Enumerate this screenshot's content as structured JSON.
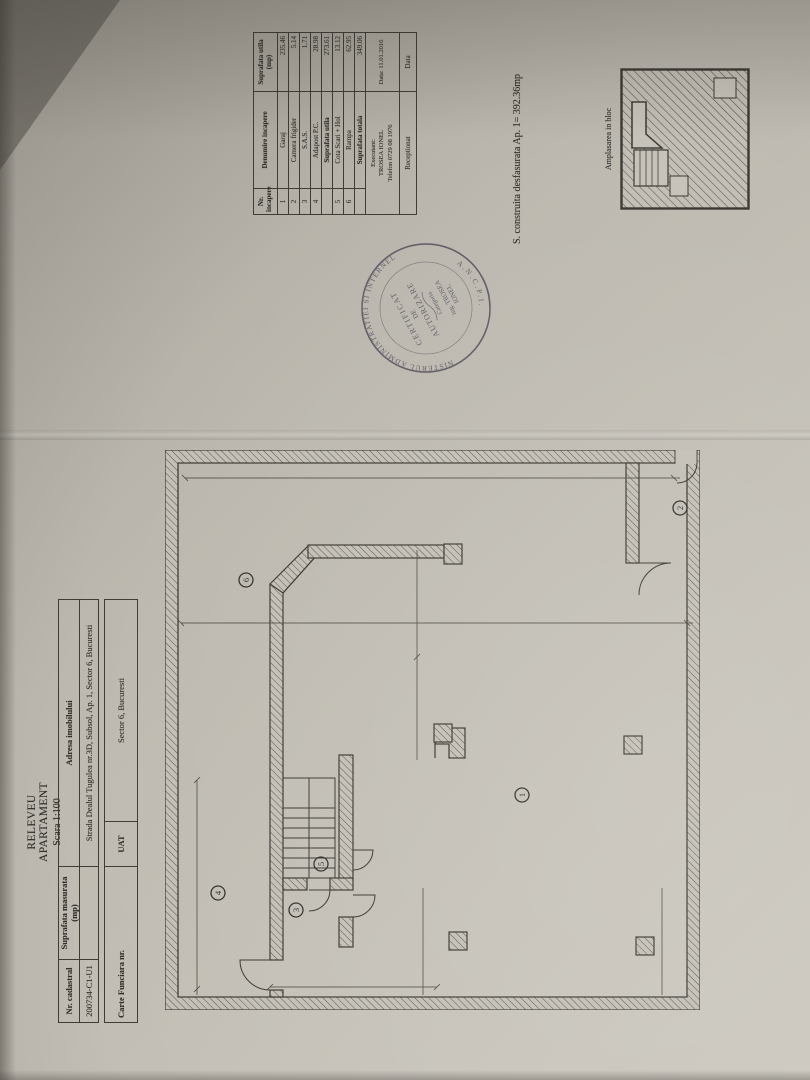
{
  "document": {
    "title": "RELEVEU APARTAMENT",
    "scale": "Scara 1:100",
    "cadastral_table": {
      "headers": [
        "Nr. cadastral",
        "Suprafata masurata (mp)",
        "Adresa imobilului"
      ],
      "values": [
        "200734-C1-U1",
        "",
        "Strada Dealul Tugulea nr.3D, Subsol, Ap. 1, Sector 6, Bucuresti"
      ]
    },
    "cf_table": {
      "label": "Carte Funciara nr.",
      "cf_value": "",
      "uat_label": "UAT",
      "uat_value": "Sector 6, Bucuresti"
    },
    "rooms_table": {
      "headers": [
        "Nr. incapere",
        "Denumire incapere",
        "Suprafata utila (mp)"
      ],
      "rows": [
        {
          "nr": "1",
          "name": "Garaj",
          "area": "235.46"
        },
        {
          "nr": "2",
          "name": "Camera frigider",
          "area": "5.14"
        },
        {
          "nr": "3",
          "name": "S.A.S.",
          "area": "1.71"
        },
        {
          "nr": "4",
          "name": "Adapost P.C.",
          "area": "28.98"
        },
        {
          "nr": "",
          "name": "Suprafata utila",
          "area": "273.61"
        },
        {
          "nr": "5",
          "name": "Cota Scari + Hol",
          "area": "13.12"
        },
        {
          "nr": "6",
          "name": "Rampa",
          "area": "62.95"
        },
        {
          "nr": "",
          "name": "Suprafata totala",
          "area": "349.06"
        }
      ],
      "executant_label": "Executant:",
      "executant_name": "TROSEA IONEL",
      "executant_phone": "Telefon 0729 08 1976",
      "date": "Data: 11.01.2016",
      "receptionat": "Receptionat",
      "data_label": "Data"
    },
    "area_note": "S. construita desfasurata Ap. 1= 392.36mp",
    "mini_plan_caption": "Amplasarea in bloc",
    "stamp": {
      "ring_text": "MINISTERUL ADMINISTRATIEI SI INTERNELOR",
      "ancpi": "A.N.C.P.I.",
      "line1": "CERTIFICAT",
      "line2": "DE",
      "line3": "AUTORIZARE",
      "line4": "Categoria",
      "line5": "ing. TROSEA",
      "line6": "IONEL"
    },
    "plan_labels": {
      "r1": "1",
      "r2": "2",
      "r3": "3",
      "r4": "4",
      "r5": "5",
      "r6": "6"
    }
  }
}
